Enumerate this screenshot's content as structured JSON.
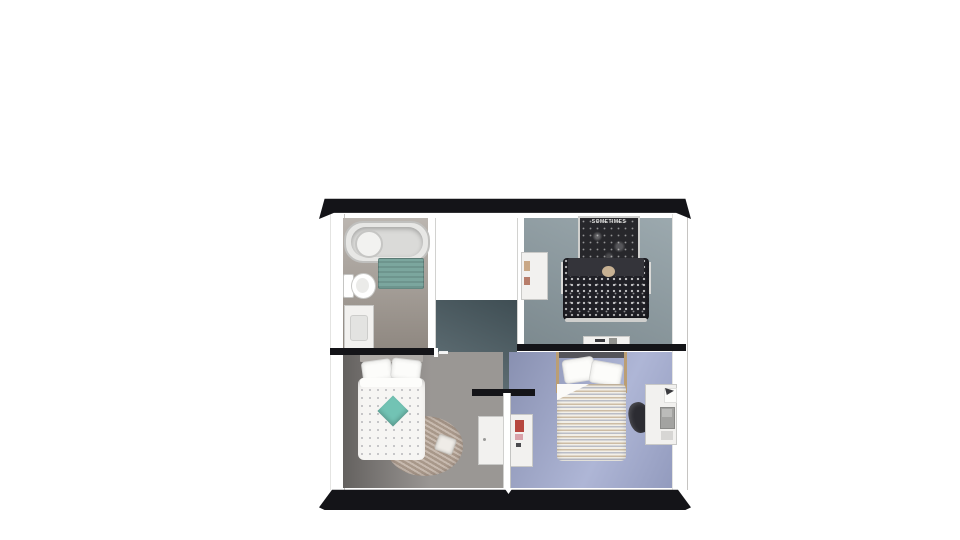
{
  "scene": {
    "description": "3D top-down floor plan rendering of an upper storey with bathroom, landing, stair void and three bedrooms",
    "poster_text": "SOMETIMES"
  },
  "palette": {
    "wall": "#141418",
    "wall_face": "#ffffff",
    "void": "#ffffff",
    "bathroom_floor": "#9e968e",
    "landing_floor": "#4d5f66",
    "bedroom_top_right_floor": "#8e9da3",
    "bedroom_bottom_left_floor": "#8f8b88",
    "bedroom_bottom_right_floor": "#9fa8ce",
    "tub": "#e7e7e5",
    "bath_mat": "#7ba69e",
    "rug": "#b5a394",
    "accent_cushion": "#72c3b4",
    "dark_duvet": "#202026",
    "duvet_white": "#f6f5f3",
    "striped_duvet": "#f2efe8",
    "wood": "#bb9e74",
    "chair": "#2c2c32",
    "furniture_white": "#f2f1ef",
    "poster_bg": "#27272b"
  },
  "rooms": {
    "bathroom": {
      "name": "Bathroom",
      "furniture": [
        "bathtub",
        "toilet",
        "washbasin",
        "bath mat"
      ]
    },
    "stair_void": {
      "name": "Stair void"
    },
    "landing": {
      "name": "Landing"
    },
    "bedroom_top_right": {
      "name": "Bedroom (dark bedding)",
      "furniture": [
        "bed with dark starry duvet",
        "poster headboard",
        "dresser",
        "low shelf"
      ]
    },
    "bedroom_bottom_left": {
      "name": "Bedroom (white bedding)",
      "furniture": [
        "single bed",
        "teal cushion",
        "round rug",
        "stool",
        "wardrobe"
      ]
    },
    "bedroom_bottom_right": {
      "name": "Bedroom (striped bedding)",
      "furniture": [
        "single bed",
        "wardrobe",
        "desk",
        "office chair"
      ]
    }
  }
}
